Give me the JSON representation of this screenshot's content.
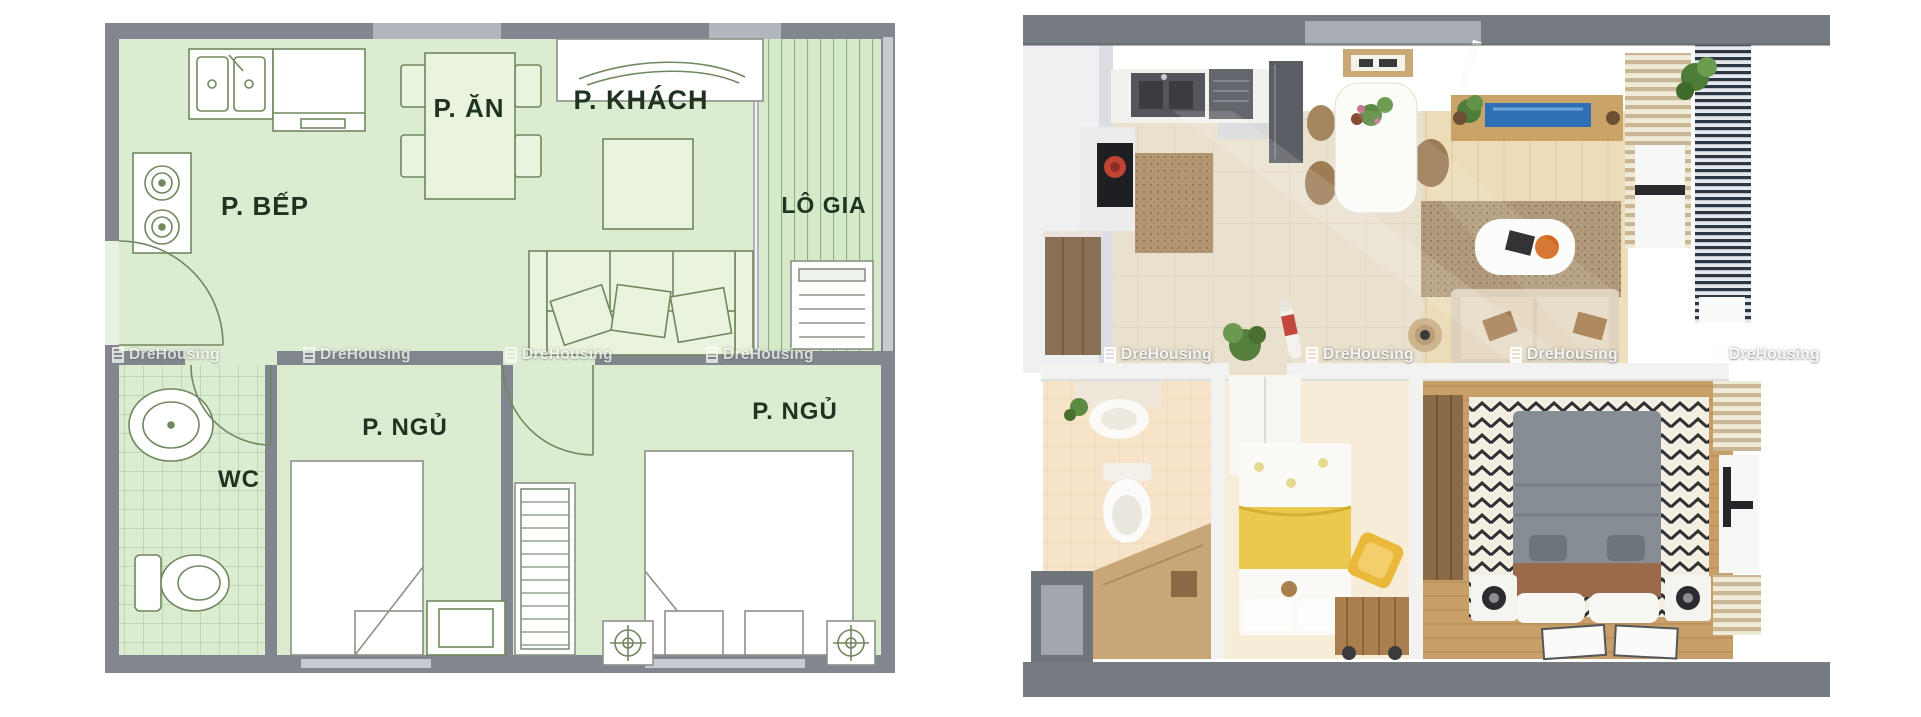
{
  "watermark": {
    "text": "DreHousing"
  },
  "plan_2d": {
    "type": "2d-floor-plan",
    "rooms": {
      "kitchen": "P. BẾP",
      "dining": "P. ĂN",
      "living": "P. KHÁCH",
      "loggia": "LÔ GIA",
      "wc": "WC",
      "bedroom_1": "P. NGỦ",
      "bedroom_2": "P. NGỦ"
    },
    "colors": {
      "floor_green": "#dcecd1",
      "wall_gray": "#82878f",
      "furniture_line": "#70875f",
      "label_text": "#1f3320"
    }
  },
  "plan_3d": {
    "type": "3d-render-top-view",
    "colors": {
      "wall_gray": "#767b82",
      "tile_floor": "#e9e0cd",
      "living_wood_floor": "#ecdcb8",
      "bedroom_wood_floor": "#c89f68",
      "bed_duvet_gray": "#878d94",
      "bed_blanket_yellow": "#eac94d",
      "loggia_slats": "#2e3744",
      "tv_screen_blue": "#2f6fb5",
      "sofa_beige": "#ddd0ba"
    }
  }
}
